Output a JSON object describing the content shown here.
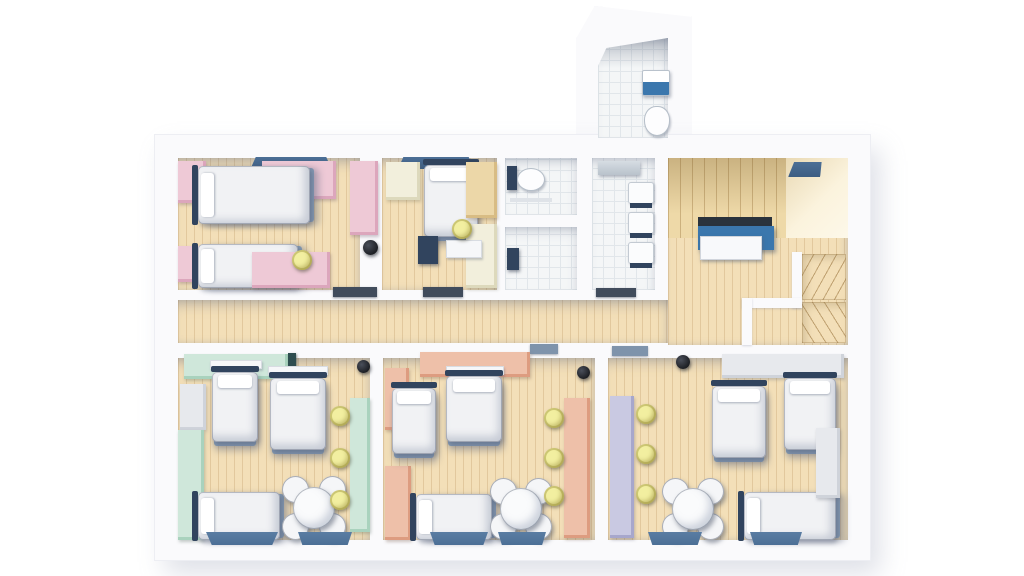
{
  "scene": {
    "kind": "3d-architectural-floor-plan-render",
    "view": "top-down orthographic",
    "description": "Rendered floor plan of a dormitory floor: two bedrooms at top-left, toilet, shower room and washroom in the top-middle, wood-panelled lobby with reception desk and winder staircase at top-right, an entrance porch WC protruding at the top, a central corridor, and three large group bedrooms along the bottom."
  },
  "palette": {
    "wall": "#fafafc",
    "wood": "#f3dfb8",
    "tile": "#f4f6f7",
    "tileline": "#e1e6ea",
    "panel": "#eed9a8",
    "pink": "#eec9d6",
    "pink-dark": "#dca6bc",
    "mint": "#cfe7da",
    "mint-dark": "#a9d2bd",
    "peach": "#eec0a9",
    "peach-dark": "#dd9c80",
    "lavender": "#c9c9e2",
    "lavender-dark": "#a7a7cc",
    "cream": "#f2efdc",
    "wood-cabinet": "#ecd7a8",
    "grey-cabinet": "#e7e9ed",
    "navy": "#31445e",
    "steel-blue": "#7e93ab",
    "window-blue": "#4c6f96",
    "reception-blue": "#3b77ad",
    "reception-top": "#2a333d",
    "counter-white": "#f8f9fb",
    "chair-yellow": "#f2efa0",
    "bin-black": "#1d1f24",
    "door-teal": "#2e4d4f",
    "bed-white": "#f1f2f4"
  },
  "rooms": [
    {
      "id": "bedroom-nw",
      "label": "bedroom pink",
      "accent": "pink",
      "beds": 2,
      "wardrobes": 3,
      "desks": 2,
      "yellow_chairs": 1,
      "windows": 1
    },
    {
      "id": "bedroom-n",
      "label": "bedroom cream",
      "accent": "cream",
      "beds": 1,
      "wardrobes": 3,
      "desks": 1,
      "yellow_chairs": 1,
      "windows": 1
    },
    {
      "id": "wc",
      "label": "toilet room",
      "fixtures": [
        "toilet"
      ]
    },
    {
      "id": "shower-room",
      "label": "shower room",
      "fixtures": [
        "shower"
      ]
    },
    {
      "id": "washroom",
      "label": "washroom",
      "fixtures": [
        "shower",
        "washbasin",
        "washbasin",
        "washbasin"
      ]
    },
    {
      "id": "lobby",
      "label": "lobby",
      "features": [
        "wood-panelling",
        "reception-desk",
        "winder-staircase"
      ]
    },
    {
      "id": "corridor",
      "label": "corridor"
    },
    {
      "id": "porch-wc",
      "label": "entrance wc",
      "fixtures": [
        "washbasin",
        "toilet"
      ]
    },
    {
      "id": "bedroom-sw",
      "label": "bedroom mint",
      "accent": "mint",
      "beds": 3,
      "wardrobes": 3,
      "desks": 1,
      "yellow_chairs": 3,
      "dining_tables": 1,
      "windows": 2
    },
    {
      "id": "bedroom-s",
      "label": "bedroom peach",
      "accent": "peach",
      "beds": 3,
      "wardrobes": 3,
      "desks": 1,
      "yellow_chairs": 3,
      "dining_tables": 1,
      "windows": 2
    },
    {
      "id": "bedroom-se",
      "label": "bedroom lavender",
      "accent": "lavender",
      "beds": 3,
      "wardrobes": 2,
      "desks": 1,
      "yellow_chairs": 3,
      "dining_tables": 1,
      "windows": 2
    }
  ]
}
